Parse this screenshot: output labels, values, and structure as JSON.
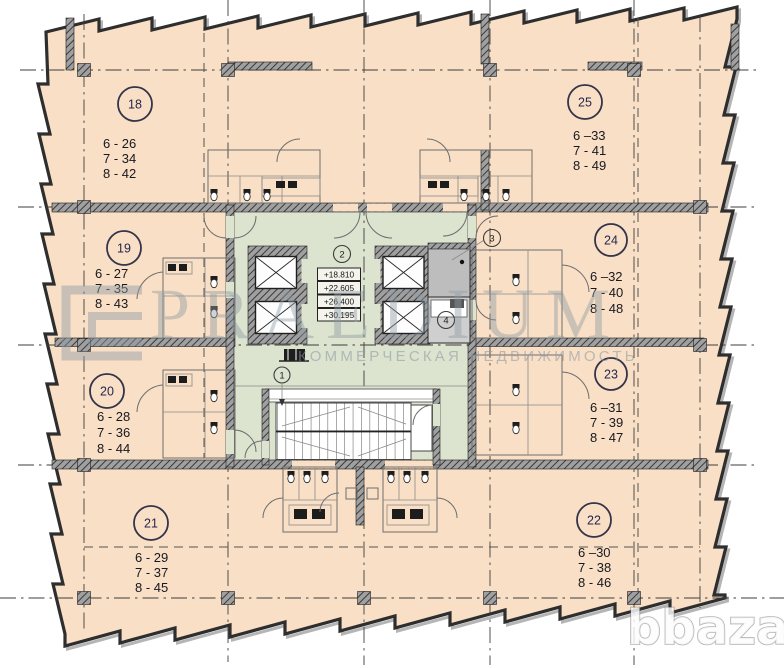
{
  "plan": {
    "units": [
      {
        "number": "18",
        "assignments": [
          "6 - 26",
          "7 - 34",
          "8 - 42"
        ]
      },
      {
        "number": "19",
        "assignments": [
          "6 - 27",
          "7 - 35",
          "8 - 43"
        ]
      },
      {
        "number": "20",
        "assignments": [
          "6 - 28",
          "7 - 36",
          "8 - 44"
        ]
      },
      {
        "number": "21",
        "assignments": [
          "6 - 29",
          "7 - 37",
          "8 - 45"
        ]
      },
      {
        "number": "22",
        "assignments": [
          "6 –30",
          "7 - 38",
          "8 - 46"
        ]
      },
      {
        "number": "23",
        "assignments": [
          "6 –31",
          "7 - 39",
          "8 - 47"
        ]
      },
      {
        "number": "24",
        "assignments": [
          "6 –32",
          "7 - 40",
          "8 - 48"
        ]
      },
      {
        "number": "25",
        "assignments": [
          "6 –33",
          "7 - 41",
          "8 - 49"
        ]
      }
    ],
    "core_labels": {
      "stair": "1",
      "lobby": "2",
      "tech": "3",
      "service": "4"
    },
    "elevations": [
      "+18.810",
      "+22.605",
      "+26.400",
      "+30.195"
    ]
  },
  "watermarks": {
    "brand": "PRAEDIUM",
    "brand_subtitle": "КОММЕРЧЕСКАЯ НЕДВИЖИМОСТЬ",
    "site": "bbaza"
  },
  "colors": {
    "floor_fill": "#f8dfc5",
    "core_fill": "#dce3ce",
    "wall": "#2b2b2b",
    "watermark": "#8d9aa5"
  }
}
